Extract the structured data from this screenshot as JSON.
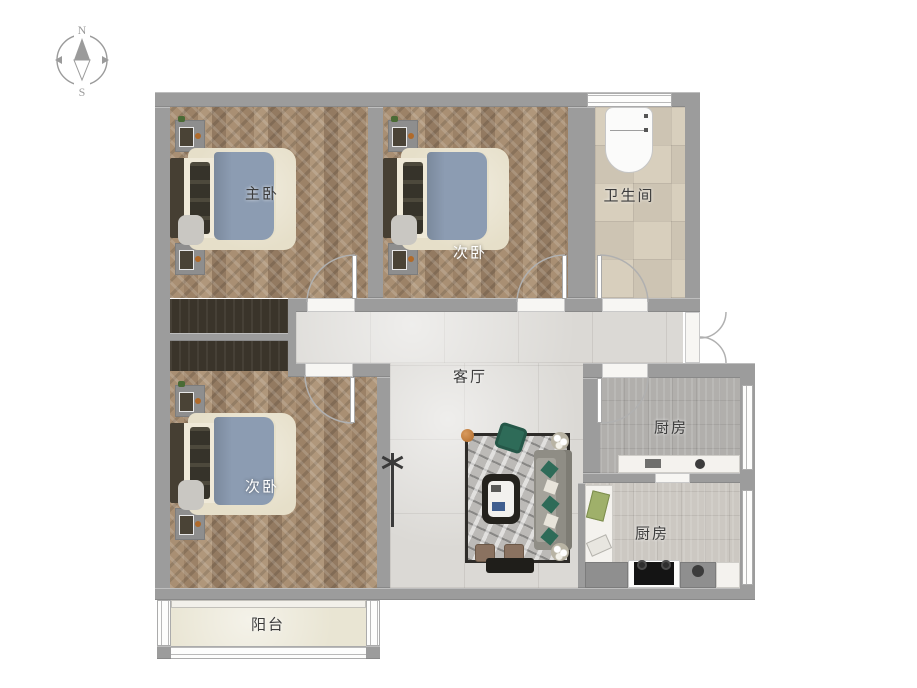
{
  "compass": {
    "north": "N",
    "south": "S"
  },
  "rooms": {
    "master_bedroom": {
      "label": "主卧"
    },
    "bedroom_top": {
      "label": "次卧"
    },
    "bedroom_bottom": {
      "label": "次卧"
    },
    "bathroom": {
      "label": "卫生间"
    },
    "living_room": {
      "label": "客厅"
    },
    "kitchen_upper": {
      "label": "厨房"
    },
    "kitchen_lower": {
      "label": "厨房"
    },
    "balcony": {
      "label": "阳台"
    }
  },
  "colors": {
    "wall": "#9c9c9c",
    "wood": "#a98f73",
    "marble": "#dbd9d5",
    "bath_tile": "#d8cfbd",
    "kitchen_tile_dark": "#b1afac",
    "kitchen_tile_light": "#ccc8c2",
    "balcony_floor": "#e9e5d3",
    "wardrobe": "#3a342a",
    "bed_blanket": "#8c9cb2",
    "bed_rug": "#e6dfc9",
    "rug_border": "#2e2c29",
    "rug_fill": "#bcbab7",
    "sofa": "#8f8d85",
    "sofa_green": "#2e6b58",
    "table_dark": "#24221d",
    "stool": "#8a7260",
    "label_dark": "#3c3c3c",
    "door_arc": "#b0b0b0"
  }
}
